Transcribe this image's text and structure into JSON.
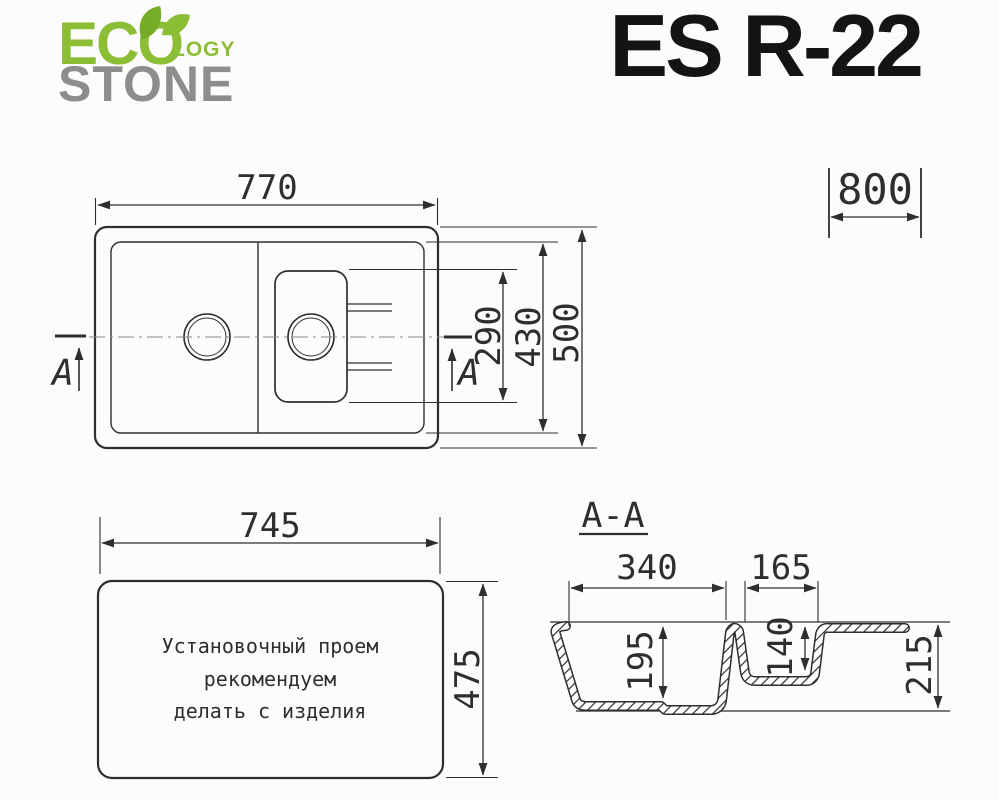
{
  "brand": {
    "eco": "ECO",
    "logy": "LOGY",
    "stone": "STONE",
    "eco_color": "#8cbe35",
    "leaf_color": "#76ad27",
    "stone_color": "#8d8d8d"
  },
  "title": "ES R-22",
  "colors": {
    "background": "#fcfcfc",
    "line": "#2e2e2e",
    "centerline": "#888888"
  },
  "top_view": {
    "width": "770",
    "cabinet_width": "800",
    "depth": "500",
    "bowl_depth": "430",
    "small_bowl_length": "290",
    "section_letter": "A"
  },
  "install_view": {
    "width": "745",
    "height": "475",
    "note_line1": "Установочный проем",
    "note_line2": "рекомендуем",
    "note_line3": "делать с изделия"
  },
  "section_view": {
    "label": "A-A",
    "big_bowl_width": "340",
    "small_bowl_width": "165",
    "big_bowl_depth": "195",
    "small_bowl_depth": "140",
    "total_depth": "215"
  }
}
